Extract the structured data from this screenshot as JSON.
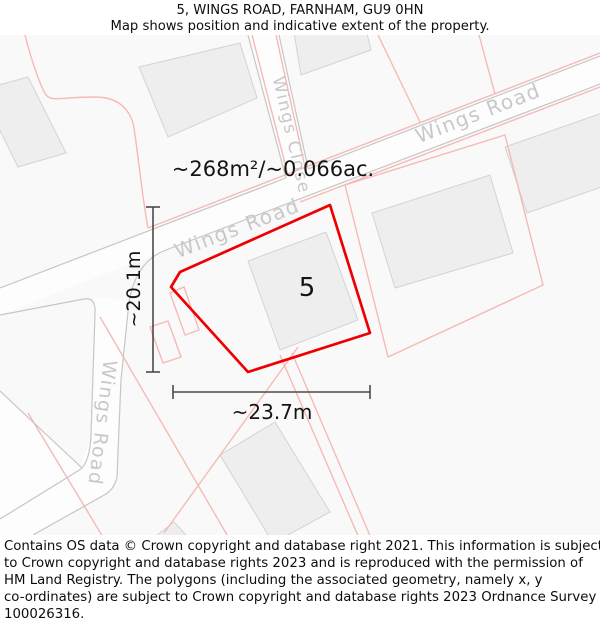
{
  "header": {
    "title": "5, WINGS ROAD, FARNHAM, GU9 0HN",
    "subtitle": "Map shows position and indicative extent of the property."
  },
  "map": {
    "area_label": "~268m²/~0.066ac.",
    "plot_number": "5",
    "height_label": "~20.1m",
    "width_label": "~23.7m",
    "road_labels": [
      {
        "text": "Wings Road",
        "position": "upper-right"
      },
      {
        "text": "Wings Road",
        "position": "center-left"
      },
      {
        "text": "Wings Road",
        "position": "lower-left-vertical"
      },
      {
        "text": "Wings Close",
        "position": "top-vertical"
      }
    ],
    "colors": {
      "plot_outline": "#ee0000",
      "parcel_line": "#f5bab5",
      "road_line": "#c7c5c5",
      "road_label": "#c9c7c7",
      "road_fill": "#fdfdfd",
      "building_fill": "#efeeee",
      "building_stroke": "#d4d2d2",
      "measure_line": "#4a4a4a"
    }
  },
  "footer": {
    "lines": [
      "Contains OS data © Crown copyright and database right 2021. This information is subject",
      "to Crown copyright and database rights 2023 and is reproduced with the permission of",
      "HM Land Registry. The polygons (including the associated geometry, namely x, y",
      "co-ordinates) are subject to Crown copyright and database rights 2023 Ordnance Survey",
      "100026316."
    ]
  }
}
